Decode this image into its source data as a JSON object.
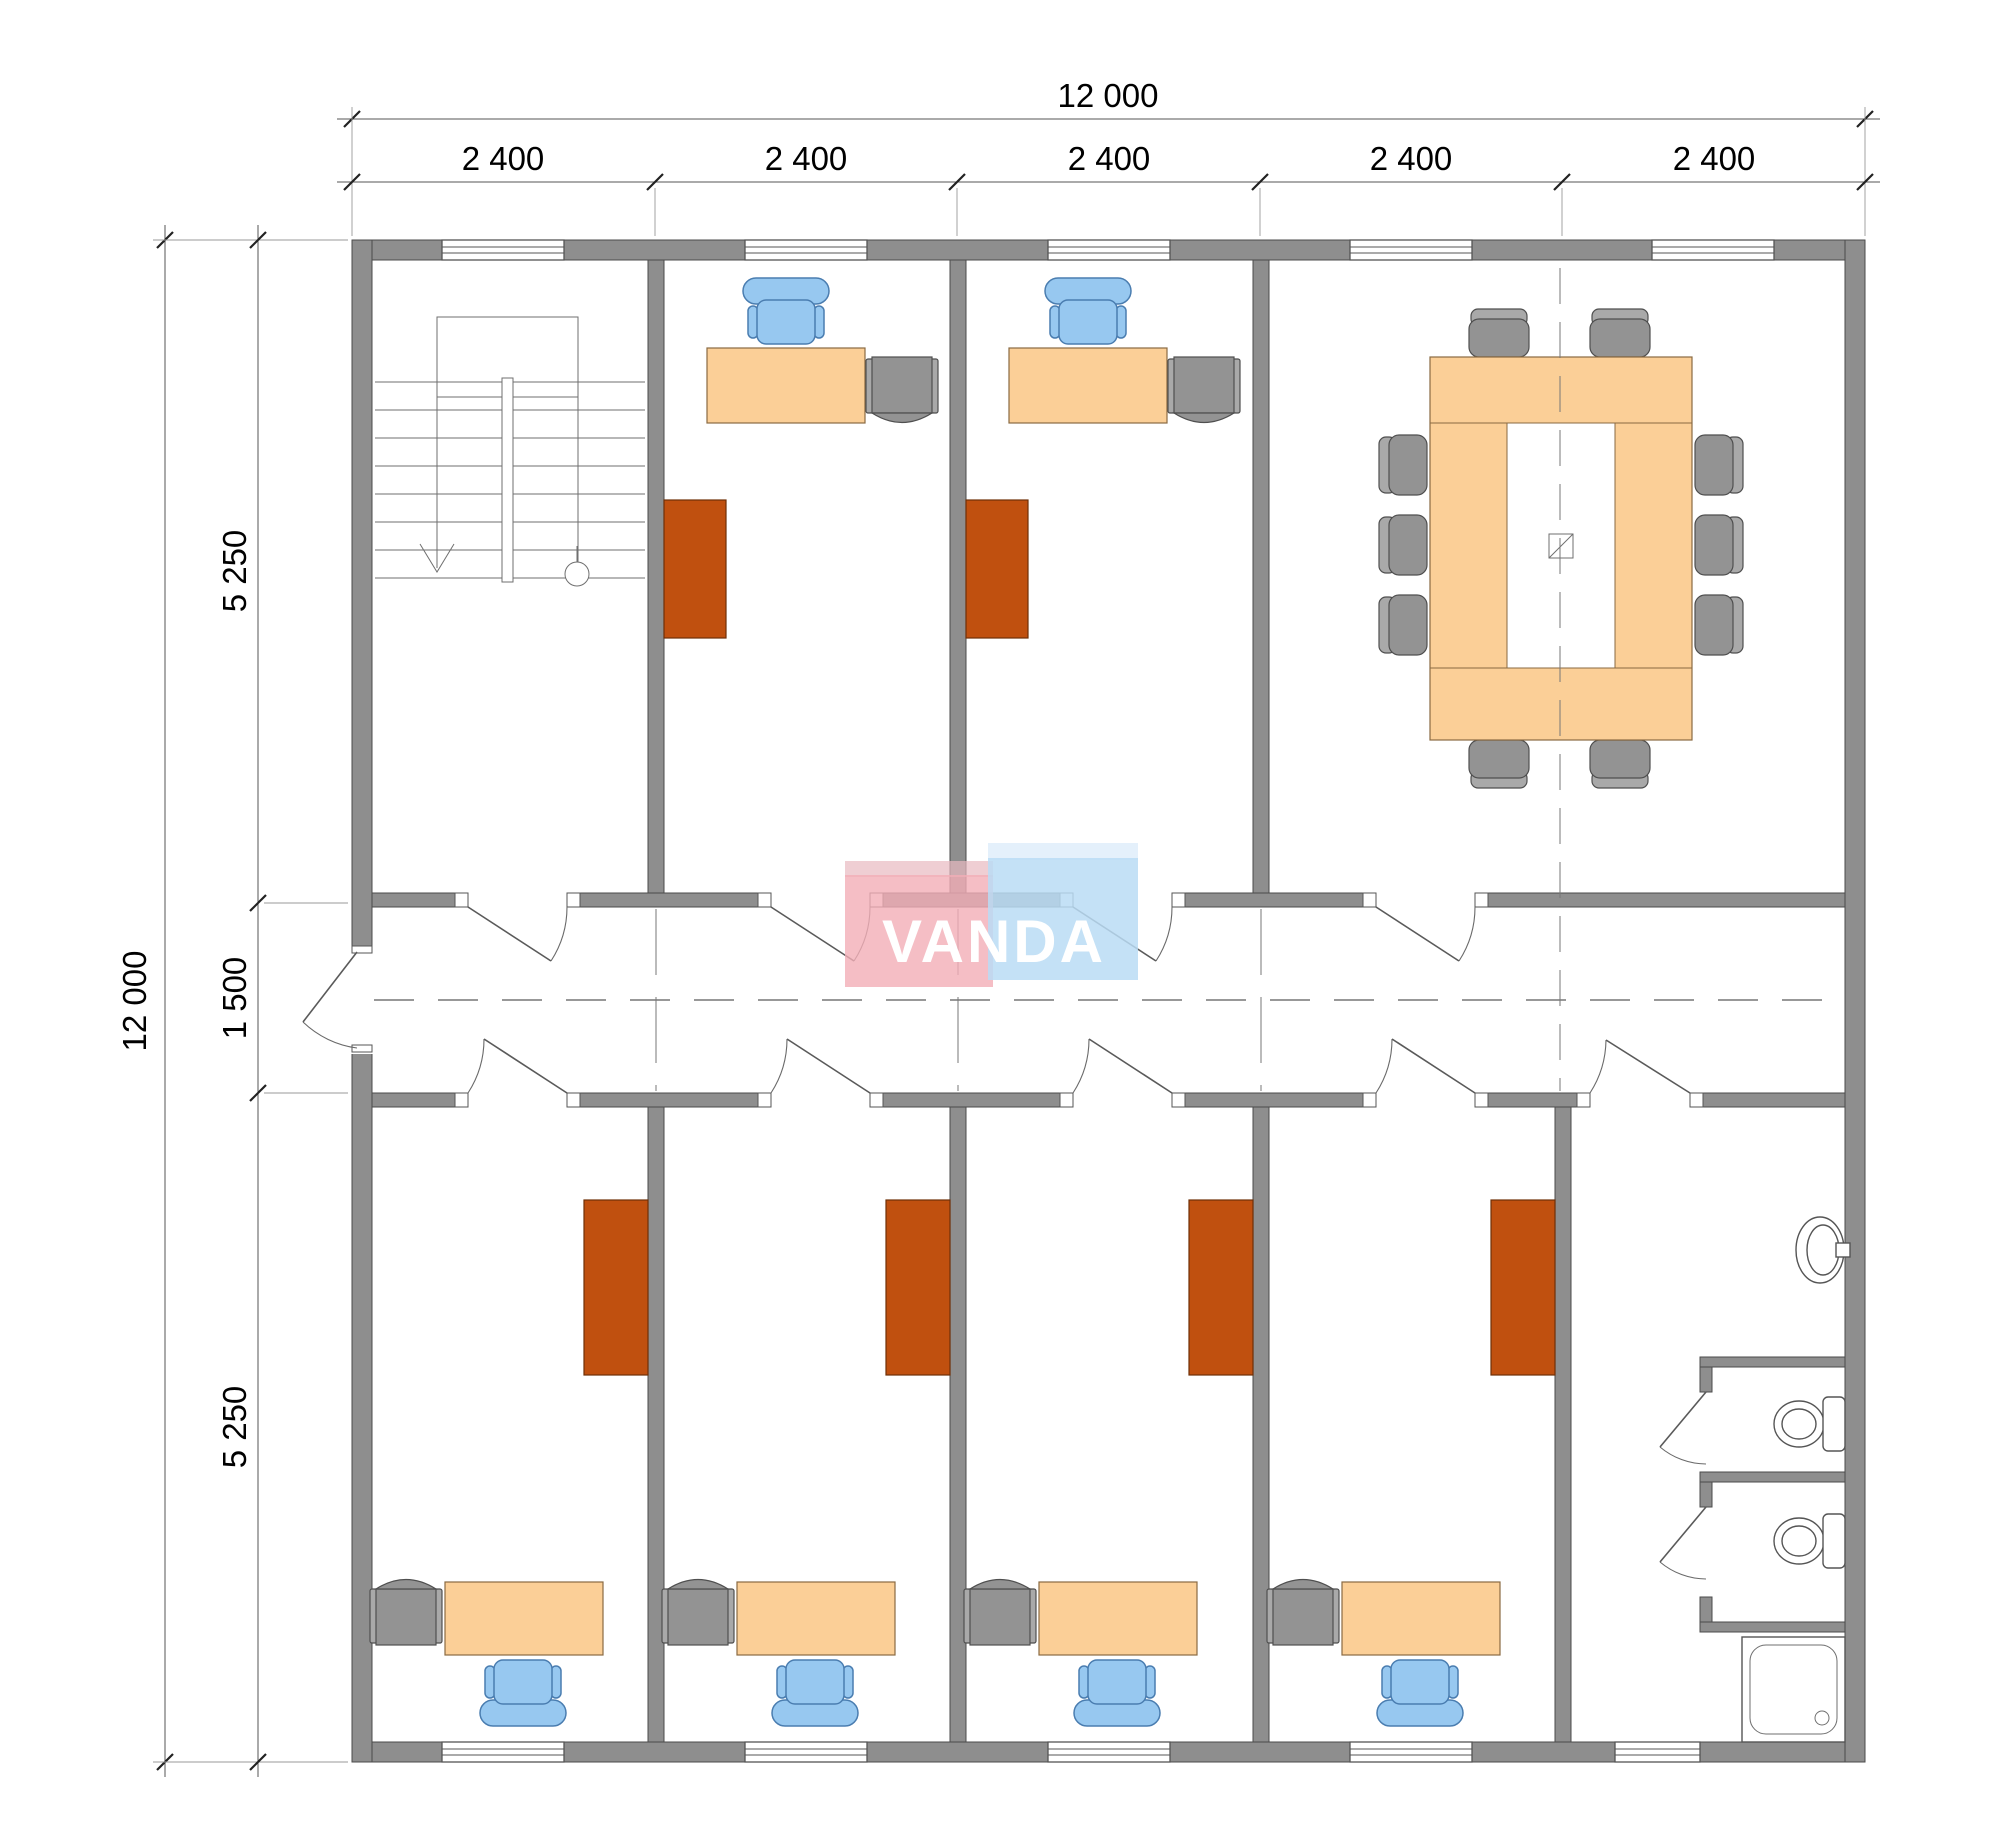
{
  "meta": {
    "title": "Office module floor plan"
  },
  "dimensions": {
    "top_overall": "12 000",
    "top_bays": [
      "2 400",
      "2 400",
      "2 400",
      "2 400",
      "2 400"
    ],
    "left_overall": "12 000",
    "left_segments": [
      "5 250",
      "1 500",
      "5 250"
    ]
  },
  "logo": {
    "text": "VANDA"
  },
  "colors": {
    "wall_fill": "#8e8e8e",
    "wall_stroke": "#4b4b4b",
    "line": "#555555",
    "wood": "#fbcf97",
    "wood_stroke": "#8a6a42",
    "chair_blue": "#97c8f0",
    "chair_blue_stroke": "#4a7db0",
    "gray": "#939393",
    "gray_light": "#a9a9a9",
    "gray_stroke": "#4f4f4f",
    "rust": "#c0500f",
    "rust_stroke": "#6f2f06",
    "logo_pink": "#f3aeb6",
    "logo_blue": "#badcf4",
    "logo_text": "#ffffff",
    "centerline": "#777777",
    "dim_line": "#555555",
    "dim_text": "#000000",
    "fixture_stroke": "#555555"
  },
  "elements": {
    "rooms": [
      "stairwell",
      "office-top-1",
      "office-top-2",
      "meeting-room",
      "corridor",
      "office-bottom-1",
      "office-bottom-2",
      "office-bottom-3",
      "office-bottom-4",
      "bathroom"
    ],
    "symbols": [
      "stairs-icon",
      "desk-icon",
      "office-chair-icon",
      "pedestal-cabinet-icon",
      "wardrobe-icon",
      "meeting-table-icon",
      "meeting-chair-icon",
      "sink-icon",
      "toilet-icon",
      "shower-tray-icon",
      "door-swing-icon",
      "window-icon"
    ]
  }
}
